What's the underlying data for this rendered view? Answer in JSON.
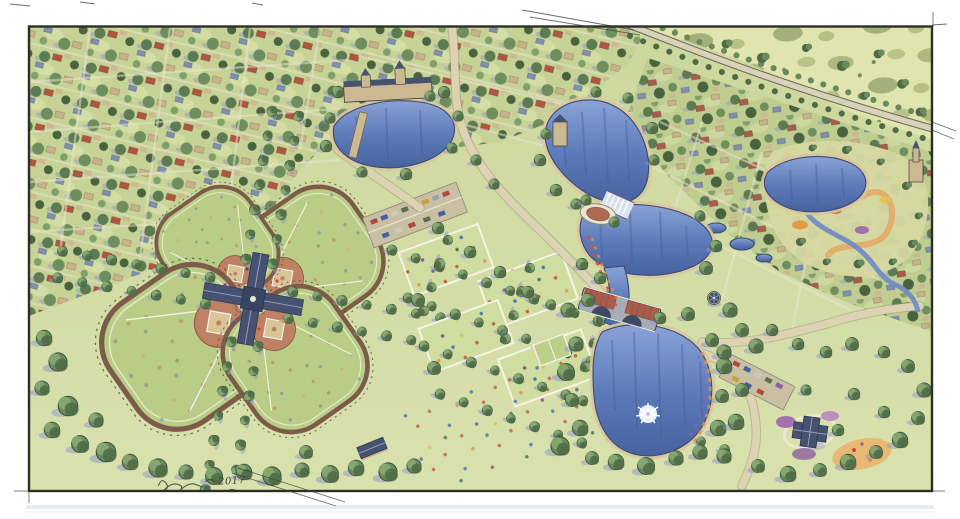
{
  "illustration": {
    "signature_year": "2017",
    "features": [
      "residential neighborhoods",
      "open meadow",
      "tree-lined arterial road",
      "four-field ballfield pinwheel complex",
      "central ballfield pavilion",
      "tree allees",
      "parking lots with cars",
      "great lawn panels with people",
      "chain of ponds",
      "spillway weir",
      "stone arch bridge with brick deck",
      "lakeside gazebo",
      "pond fountain",
      "overlook plaza",
      "stream garden with sandy paths",
      "garden pavilion with flower beds",
      "civic building",
      "church tower",
      "park border trees"
    ],
    "counts": {
      "ballfields": 4,
      "ponds": 5
    }
  },
  "palette": {
    "paper": "#ffffff",
    "ink": "#3a4036",
    "lawn": "#ccd79d",
    "lawn2": "#cfdda0",
    "field": "#b9cd87",
    "meadow": "#e0e4ae",
    "tree1": "#4f6a47",
    "tree2": "#688a5c",
    "tree3": "#87a873",
    "shadow": "#8b96c8",
    "water": "#6d89c4",
    "waterDeep": "#47639f",
    "shore": "#d8c7a0",
    "road": "#ddd3b2",
    "infield": "#bf8164",
    "brick": "#a85c4c",
    "roof": "#465270",
    "wall": "#cdb991",
    "sand": "#e2b06c",
    "flower1": "#cf4f3e",
    "flower2": "#e2913f",
    "flower3": "#9a5fae",
    "stone": "#a7adb6"
  }
}
